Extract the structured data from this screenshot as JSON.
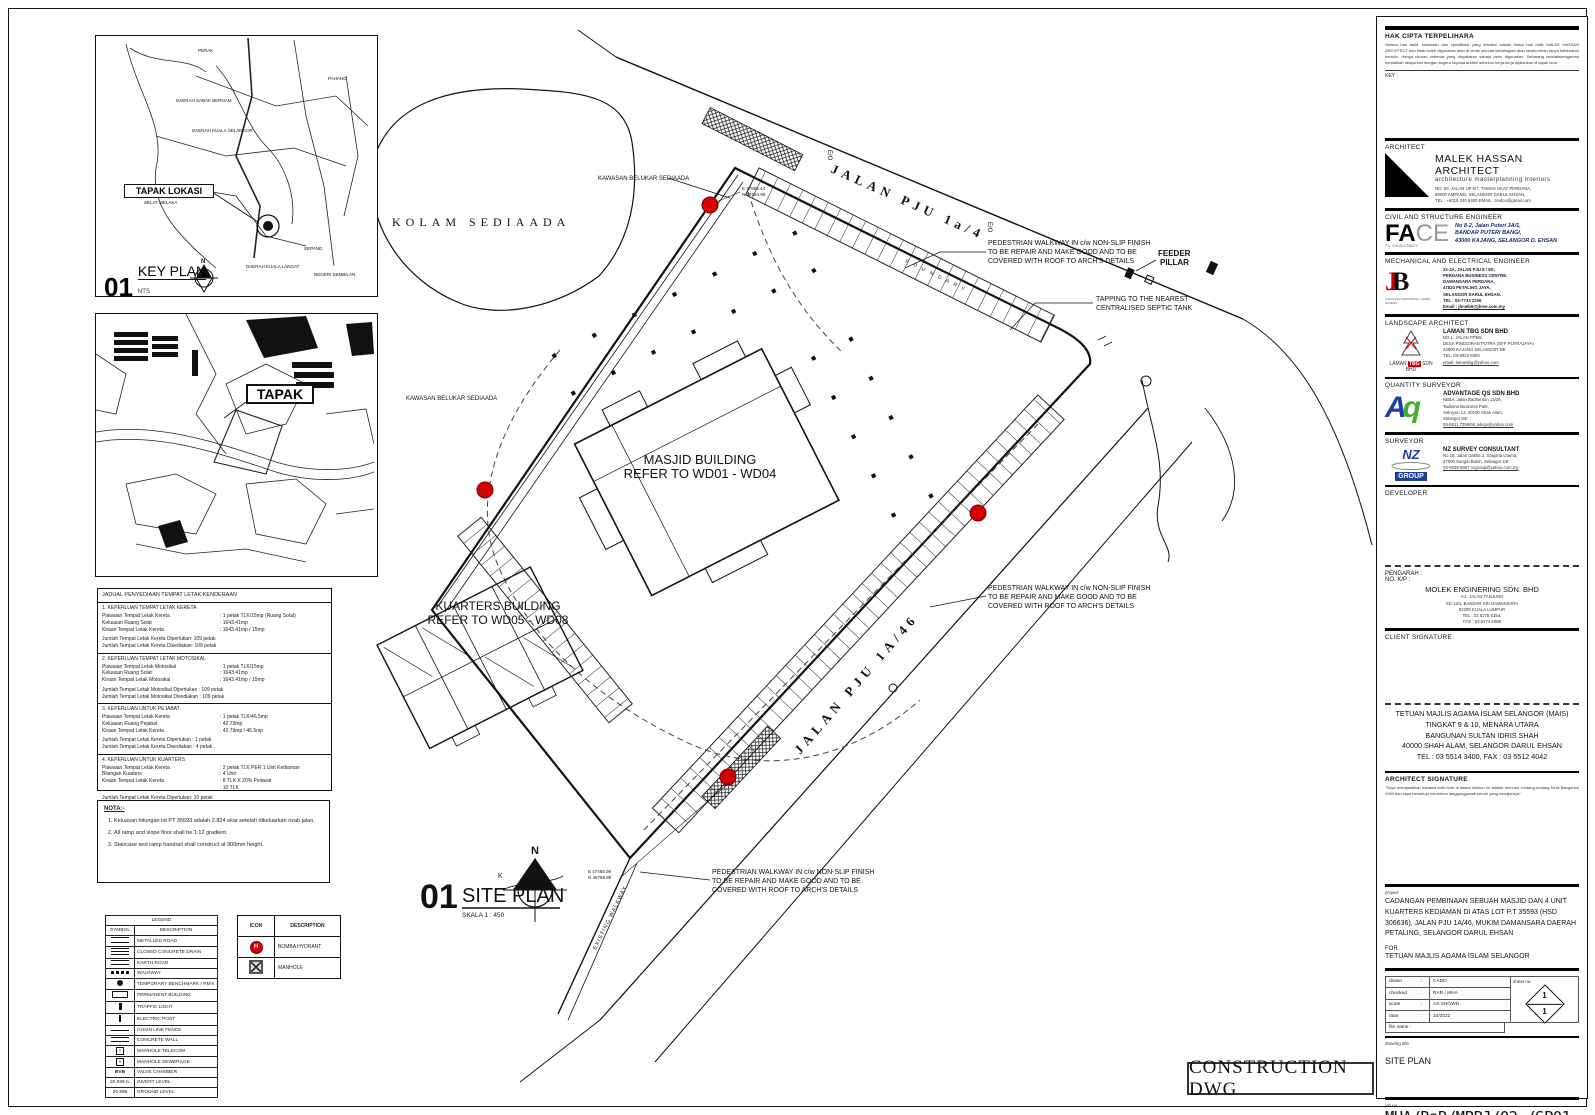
{
  "page": {
    "construction_stamp": "CONSTRUCTION DWG"
  },
  "key_plan": {
    "num": "01",
    "title": "KEY PLAN",
    "scale": "NTS",
    "callout": "TAPAK LOKASI",
    "compass_n": "N",
    "labels": [
      "PERAK",
      "PAHANG",
      "DAERAH SABAK BERNAM",
      "DAERAH KUALA SELANGOR",
      "SELAT MELAKA",
      "DAERAH KUALA LANGAT",
      "SEPANG",
      "NEGERI SEMBILAN"
    ]
  },
  "tapak_plan": {
    "callout": "TAPAK"
  },
  "parking_table": {
    "title": "JADUAL PENYEDIAAN TEMPAT LETAK KENDERAAN",
    "s1": {
      "heading": "1. KEPERLUAN TEMPAT LETAK KERETA",
      "r1": [
        "Piawaian Tempat Letak Kereta",
        ": 1 petak TLK/15mp (Ruang Solat)"
      ],
      "r2": [
        "Keluasan Ruang Solat",
        ": 1643.41mp"
      ],
      "r3": [
        "Kiraan Tempat Letak Kereta",
        ": 1643.41mp / 15mp"
      ],
      "t1": "Jumlah Tempat Letak Kereta Diperlukan: 109 petak",
      "t2": "Jumlah Tempat Letak Kereta Disediakan: 109 petak"
    },
    "s2": {
      "heading": "2. KEPERLUAN TEMPAT LETAK MOTOSIKAL",
      "r1": [
        "Piawaian Tempat Letak Motosikal",
        ": 1 petak TLK/15mp"
      ],
      "r2": [
        "Keluasan Ruang Solat",
        ": 1643.41mp"
      ],
      "r3": [
        "Kiraan Tempat Letak Motosikal",
        ": 1643.41mp / 15mp"
      ],
      "t1": "Jumlah Tempat Letak Motosikal Diperlukan   : 109 petak",
      "t2": "Jumlah Tempat Letak Motosikal Disediakan   : 109 petak"
    },
    "s3": {
      "heading": "3. KEPERLUAN UNTUK PEJABAT",
      "r1": [
        "Piawaian Tempat Letak Kereta",
        ": 1 petak TLK/46.5mp"
      ],
      "r2": [
        "Keluasan Ruang Pejabat",
        ": 42.73mp"
      ],
      "r3": [
        "Kiraan Tempat Letak Kereta",
        ": 42.73mp / 46.5mp"
      ],
      "t1": "Jumlah Tempat Letak Kereta Diperlukan      : 1 petak",
      "t2": "Jumlah Tempat Letak Kereta Disediakan      : 4 petak"
    },
    "s4": {
      "heading": "4. KEPERLUAN UNTUK KUARTERS",
      "r1": [
        "Piawaian Tempat Letak Kereta",
        ": 2 petak TLK PER 1 Unit Kediaman"
      ],
      "r2": [
        "Bilangan Kuarters",
        ":  4 Unit"
      ],
      "r3": [
        "Kiraan Tempat Letak Kereta",
        ": 8 TLK X 20% Pelawat"
      ],
      "r4": [
        "",
        ":  10 TLK"
      ],
      "t1": "Jumlah Tempat Letak Kereta Diperlukan: 10 petak",
      "t2": "Jumlah Tempat Letak Kereta Disediakan      : 10 petak"
    }
  },
  "nota": {
    "title": "NOTA:-",
    "i1": "Keluasan hitungan lot PT 35593 adalah 2.824 ekar setelah dikeluarkan rizab jalan.",
    "i2": "All ramp and slope floor shall be 1:12 gradient.",
    "i3": "Staircase and ramp handrail shall construct at 900mm height."
  },
  "legend": {
    "title": "LEGEND",
    "col_symbol": "SYMBOL",
    "col_desc": "DESCRIPTION",
    "rows": [
      {
        "label": "METALLED ROAD"
      },
      {
        "label": "CLOSED CONCRETE DRAIN"
      },
      {
        "label": "EARTH ROAD"
      },
      {
        "label": "WALKWAY"
      },
      {
        "label": "TEMPORARY BENCHMARK / RM's"
      },
      {
        "label": "PERMANENT BUILDING"
      },
      {
        "label": "TRAFFIC LIGHT"
      },
      {
        "label": "ELECTRIC POST"
      },
      {
        "label": "CHAIN LINK FENCE"
      },
      {
        "label": "CONCRETE WALL"
      },
      {
        "label": "MANHOLE TELECOM"
      },
      {
        "label": "MANHOLE SEWERAGE"
      },
      {
        "label": "VALVE CHAMBER",
        "sym_text": "BVB"
      },
      {
        "label": "INVERT LEVEL",
        "sym_text": "20.999 IL"
      },
      {
        "label": "GROUND LEVEL",
        "sym_text": "20.999"
      }
    ]
  },
  "icon_table": {
    "col_icon": "ICON",
    "col_desc": "DESCRIPTION",
    "hydrant_label": "BOMBA HYDRANT",
    "hydrant_glyph": "H",
    "manhole_label": "MANHOLE"
  },
  "site_plan": {
    "num": "01",
    "title": "SITE PLAN",
    "scale": "SKALA 1 : 450",
    "compass_n": "N",
    "compass_k": "K",
    "kolam": "KOLAM SEDIAADA",
    "belukar": "KAWASAN BELUKAR SEDIAADA",
    "jalan_top": "JALAN PJU 1a/4",
    "jalan_bottom": "JALAN PJU 1A/46",
    "boundary": "B O U N D A R Y",
    "masjid_l1": "MASJID BUILDING",
    "masjid_l2": "REFER TO WD01 - WD04",
    "kuarters_l1": "KUARTERS BUILDING",
    "kuarters_l2": "REFER TO WD05 - WD08",
    "feeder_l1": "FEEDER",
    "feeder_l2": "PILLAR",
    "septic_l1": "TAPPING TO THE NEAREST",
    "septic_l2": "CENTRALISED SEPTIC TANK",
    "walkway_l1": "PEDESTRIAN WALKWAY IN c/w NON-SLIP FINISH",
    "walkway_l2": "TO BE REPAIR AND MAKE GOOD AND TO BE",
    "walkway_l3": "COVERED WITH ROOF TO ARCH'S DETAILS",
    "existing_walkway": "EXISTING WALKWAY",
    "coord_e": "E 47555.44",
    "coord_n": "N 47554.99",
    "coord_e2": "E 47458.08",
    "coord_n2": "N 46758.99",
    "eo": "E/O"
  },
  "title_block": {
    "hak_title": "HAK CIPTA TERPELIHARA",
    "hak_body": "Semua hak taklif, kelulusan dan spesifikasi yang tercatat adalah kekal hak milik MALEK HASSAN ARCHITECT dan tidak boleh digunakan atau di cetak semula sebahagian atau keseluruhan tanpa kebenaran bertulis. Hanya ukuran sebenar yang dinyatakan sahaja perlu digunakan. Sebarang ketidakseragaman hendaklah dilaporkan dengan segera kepada arkitek sebelum kerja-kerja dijalankan di tapak bina.",
    "key_label": "KEY :",
    "architect": {
      "section": "ARCHITECT",
      "name": "MALEK HASSAN ARCHITECT",
      "tagline": "architecture  masterplanning  interiors",
      "a1": "NO. 69, JALAN UP 5/7, TAMAN UKAY PERDANA,",
      "a2": "68000 AMPANG, SELANGOR DARUL EHSAN,",
      "a3": "TEL : +6019 240 6400 EMAIL : tredco@gmail.com"
    },
    "civil": {
      "section": "CIVIL AND STRUCTURE ENGINEER",
      "logo_fa": "FA",
      "logo_ce": "CE",
      "logo_sub": "F.A. CONSULTANCY",
      "a1": "No 8-2, Jalan Puteri 3A/1,",
      "a2": "BANDAR PUTERI BANGI,",
      "a3": "43000 KAJANG, SELANGOR D. EHSAN"
    },
    "mech": {
      "section": "MECHANICAL AND ELECTRICAL ENGINEER",
      "logo_j": "J",
      "logo_b": "B",
      "logo_sub": "JURUTERA PERUNDING JAMES EASERN",
      "a1": "22-2A, JALAN PJU 8 / 5D,",
      "a2": "PERDANA BUSINESS CENTRE,",
      "a3": "DAMANSARA PERDANA,",
      "a4": "47820 PETALING JAYA,",
      "a5": "SELANGOR DARUL EHSAN.",
      "a6": "TEL : 03-7733 2206",
      "a7": "Email : jbmeb9@jbme.com.my"
    },
    "landscape": {
      "section": "LANDSCAPE ARCHITECT",
      "logo_1": "LAMAN",
      "logo_2": "TBG",
      "logo_3": "SDN BHD",
      "name": "LAMAN TBG SDN BHD",
      "a1": "NO 1, JALAN PP5/5,",
      "a2": "DESA PINGGIRAN PUTRA (OFF PUTRAJAYA)",
      "a3": "43000 KAJANG SELANGOR DE",
      "a4": "TEL: 03-8922 8383",
      "a5": "email: lamantbg@yahoo.com"
    },
    "qs": {
      "section": "QUANTITY SURVEYOR",
      "logo_a": "A",
      "logo_q": "q",
      "name": "ADVANTAGE QS SDN BHD",
      "a1": "NB5A, Jalan Badminton 13/29,",
      "a2": "Tadisma Business Park,",
      "a3": "Seksyen 13, 40100 Shah Alam,",
      "a4": "Selangor DE",
      "a5": "03-5511 7259/58 advqs@yahoo.com"
    },
    "surveyor": {
      "section": "SURVEYOR",
      "logo_nz": "NZ",
      "logo_group": "GROUP",
      "name": "NZ SURVEY CONSULTANT",
      "a1": "No 18, Jalan Dahlia 2, Saujana Utama,",
      "a2": "47000 Sungai Buloh, Selangor DE",
      "a3": "03-6038 5887 nzgroup@yahoo.com.my"
    },
    "developer_label": "DEVELOPER",
    "pengarah": {
      "l1": "PENGARAH :",
      "l2": "NO. K/P :",
      "company": "MOLEK ENGINERING SDN. BHD",
      "a1": "4-2, JALAN TANJUNG",
      "a2": "SD 13/1, BANDAR SRI DAMANSARA",
      "a3": "52200 KUALA LUMPUR",
      "a4": "TEL : 03 6275 6354,",
      "a5": "FAX : 03 6274 6086"
    },
    "client_sig_label": "CLIENT SIGNATURE",
    "client": {
      "l1": "TETUAN MAJLIS AGAMA ISLAM SELANGOR (MAIS)",
      "l2": "TINGKAT 9 & 10, MENARA UTARA",
      "l3": "BANGUNAN SULTAN IDRIS SHAH",
      "l4": "40000 SHAH ALAM, SELANGOR DARUL EHSAN",
      "l5": "TEL : 03 5514 3400, FAX : 03 5512 4042"
    },
    "arch_sig_label": "ARCHITECT SIGNATURE",
    "arch_sig_fine": "\"Saya mempastikan bahawa butir-butir di dalam lukisan ini adalah menurut Undang-undang Kecil Bangunan 1984 dan saya bersetuju menerima tanggungjawab penuh yang sewajarnya\"",
    "project_label": "project",
    "project_text": "CADANGAN PEMBINAAN SEBUAH MASJID DAN 4 UNIT KUARTERS KEDIAMAN DI ATAS LOT P.T 35593 (HSD 306636), JALAN PJU 1A/46, MUKIM DAMANSARA DAERAH PETALING, SELANGOR DARUL EHSAN",
    "for_label": "FOR.",
    "for_value": "TETUAN MAJLIS AGAMA ISLAM SELANGOR",
    "meta": {
      "drawn_label": "drawn",
      "drawn": "CADD",
      "checked_label": "checked",
      "checked": "RAR / MHA",
      "scale_label": "scale",
      "scale": "AS SHOWN",
      "date_label": "date",
      "date": "10/2022",
      "file_label": "file name :",
      "sheet_label": "sheet no.",
      "sheet_top": "1",
      "sheet_bottom": "1"
    },
    "drawing_title_label": "drawing title",
    "drawing_title": "SITE PLAN",
    "job_label": "job no.",
    "job_no": "MHA/RaR/MPPJ/02 /SP01"
  }
}
